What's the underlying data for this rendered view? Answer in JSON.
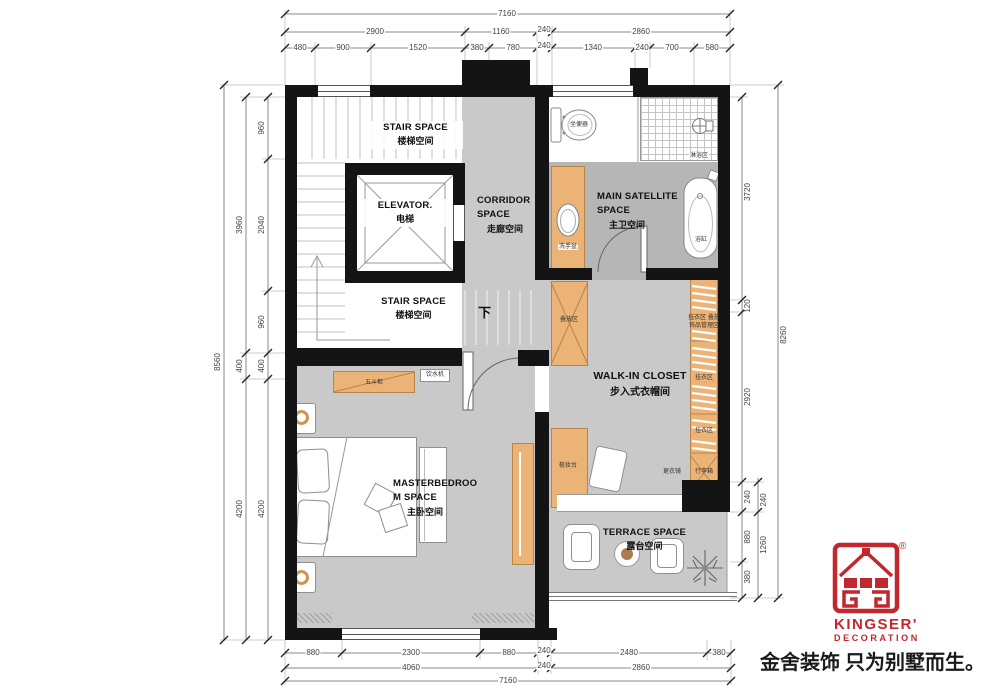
{
  "colors": {
    "wall": "#141414",
    "floor": "#c9c9c9",
    "bathroom_floor": "#b6b6b6",
    "furniture_orange": "#ecb377",
    "brand_red": "#c1272d"
  },
  "dims": {
    "top": {
      "total": "7160",
      "row1": [
        "2900",
        "1160",
        "240",
        "2860"
      ],
      "row2": [
        "480",
        "900",
        "1520",
        "380",
        "780",
        "240",
        "1340",
        "240",
        "700",
        "580"
      ]
    },
    "left": {
      "outer": "8560",
      "mid": [
        "3960",
        "400",
        "4200"
      ],
      "inner": [
        "960",
        "2040",
        "960",
        "400",
        "4200"
      ]
    },
    "right": {
      "outer": "8260",
      "mid": [
        "240",
        "1260"
      ],
      "inner": [
        "3720",
        "120",
        "2920",
        "240",
        "880",
        "380"
      ]
    },
    "bottom": {
      "row1": [
        "880",
        "2300",
        "880",
        "240",
        "2480",
        "380"
      ],
      "row2": [
        "4060",
        "240",
        "2860"
      ],
      "total": "7160"
    }
  },
  "rooms": {
    "stair_upper_en": "STAIR SPACE",
    "stair_upper_zh": "楼梯空间",
    "elevator_en": "ELEVATOR.",
    "elevator_zh": "电梯",
    "corridor_en1": "CORRIDOR",
    "corridor_en2": "SPACE",
    "corridor_zh": "走廊空间",
    "stair_lower_en": "STAIR SPACE",
    "stair_lower_zh": "楼梯空间",
    "bath_en1": "MAIN SATELLITE",
    "bath_en2": "SPACE",
    "bath_zh": "主卫空间",
    "closet_en": "WALK-IN CLOSET",
    "closet_zh": "步入式衣帽间",
    "bedroom_en1": "MASTERBEDROO",
    "bedroom_en2": "M SPACE",
    "bedroom_zh": "主卧空间",
    "terrace_en": "TERRACE SPACE",
    "terrace_zh": "露台空间",
    "down_mark": "下"
  },
  "furniture": {
    "toilet": "坐便器",
    "shower_zone": "淋浴区",
    "basin": "洗手盆",
    "bathtub": "浴缸",
    "dresser": "五斗柜",
    "water_dispenser": "饮水机",
    "fold_zone": "叠放区",
    "hang_zone_a1": "挂衣区 叠放",
    "hang_zone_a2": "饰品管理区",
    "hang_zone_b": "挂衣区",
    "hang_zone_c": "挂衣区",
    "mirror": "更衣镜",
    "luggage": "行李箱",
    "dressing_table": "梳妆台"
  },
  "logo": {
    "brand": "KINGSER'",
    "division": "DECORATION",
    "registered": "®",
    "slogan": "金舍装饰 只为别墅而生。"
  }
}
